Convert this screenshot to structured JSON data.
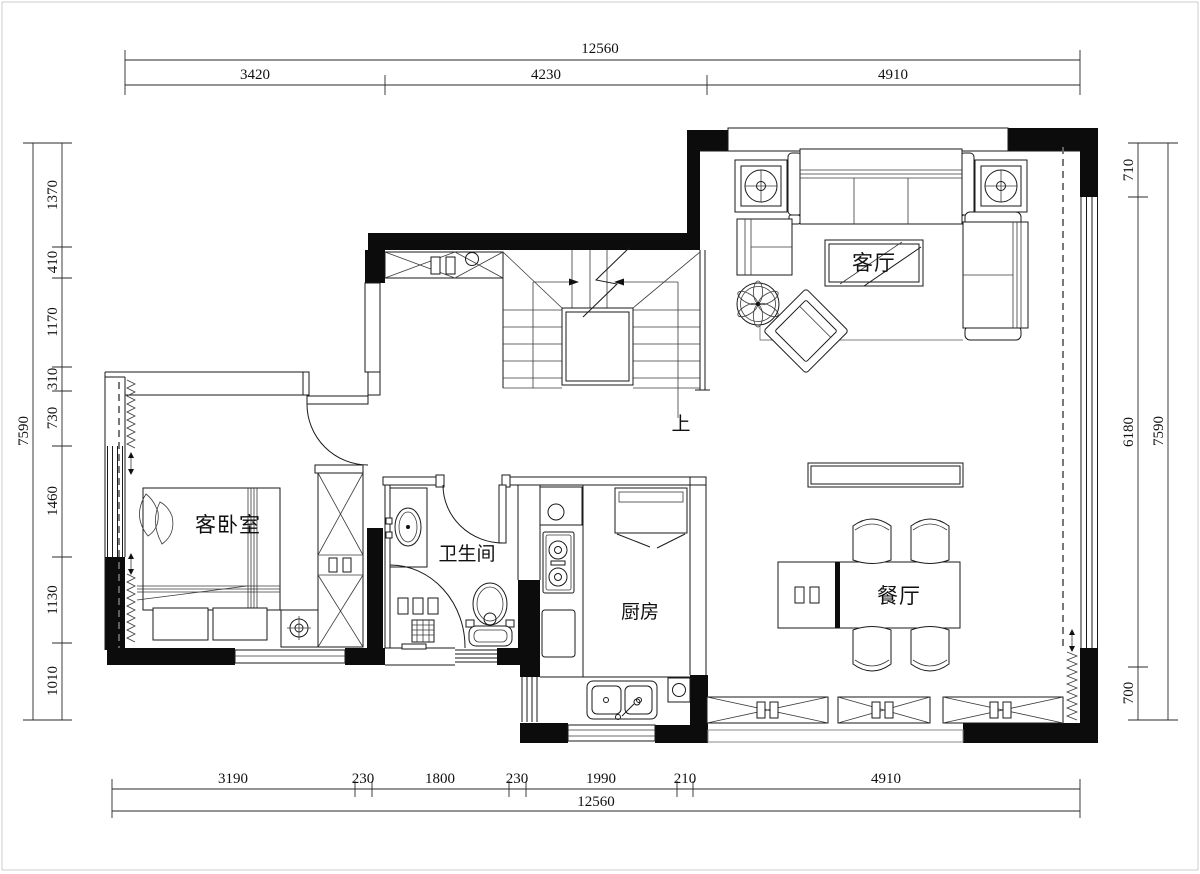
{
  "drawing": {
    "type": "residential floor plan"
  },
  "dimensions": {
    "top": {
      "total": "12560",
      "segments": [
        "3420",
        "4230",
        "4910"
      ]
    },
    "bottom": {
      "total": "12560",
      "segments": [
        "3190",
        "230",
        "1800",
        "230",
        "1990",
        "210",
        "4910"
      ]
    },
    "left": {
      "total": "7590",
      "segments": [
        "1370",
        "410",
        "1170",
        "310",
        "730",
        "1460",
        "1130",
        "1010"
      ]
    },
    "right": {
      "total": "7590",
      "segments": [
        "710",
        "6180",
        "700"
      ]
    }
  },
  "rooms": {
    "living_room": "客厅",
    "guest_bedroom": "客卧室",
    "bathroom": "卫生间",
    "kitchen": "厨房",
    "dining_room": "餐厅"
  },
  "stairs": {
    "direction_label": "上"
  },
  "colors": {
    "wall_fill": "#0c0c0c",
    "line": "#1a1a1a",
    "background": "#ffffff"
  }
}
